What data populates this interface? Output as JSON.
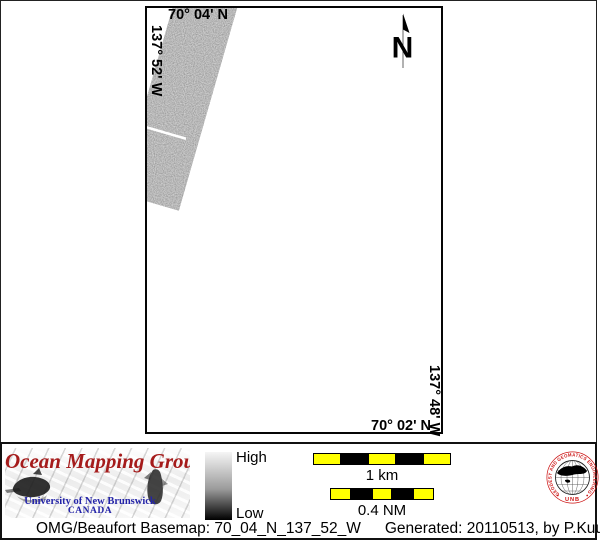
{
  "map": {
    "top_label": "70° 04' N",
    "left_label": "137° 52' W",
    "right_label": "137° 48' W",
    "bottom_label": "70° 02' N",
    "north_label": "N"
  },
  "legend": {
    "logo": {
      "title": "Ocean Mapping Group",
      "university": "University of New Brunswick",
      "country": "CANADA"
    },
    "colorbar": {
      "high_label": "High",
      "low_label": "Low"
    },
    "scalebars": [
      {
        "label": "1 km"
      },
      {
        "label": "0.4 NM"
      }
    ],
    "seal": {
      "ring_text": "GEODESY AND GEOMATICS ENGINEERING",
      "bottom_text": "UNB"
    }
  },
  "footer": {
    "basemap_text": "OMG/Beaufort Basemap: 70_04_N_137_52_W",
    "generated_text": "Generated: 20110513, by P.Kuus"
  },
  "colors": {
    "scalebar_yellow": "#ffff00",
    "logo_red": "#a51b1b",
    "logo_blue": "#2424a8",
    "seal_red": "#cc1111",
    "swath_gray": "#909090",
    "colorbar_top": "#f5f5f5",
    "colorbar_bottom": "#000000"
  }
}
